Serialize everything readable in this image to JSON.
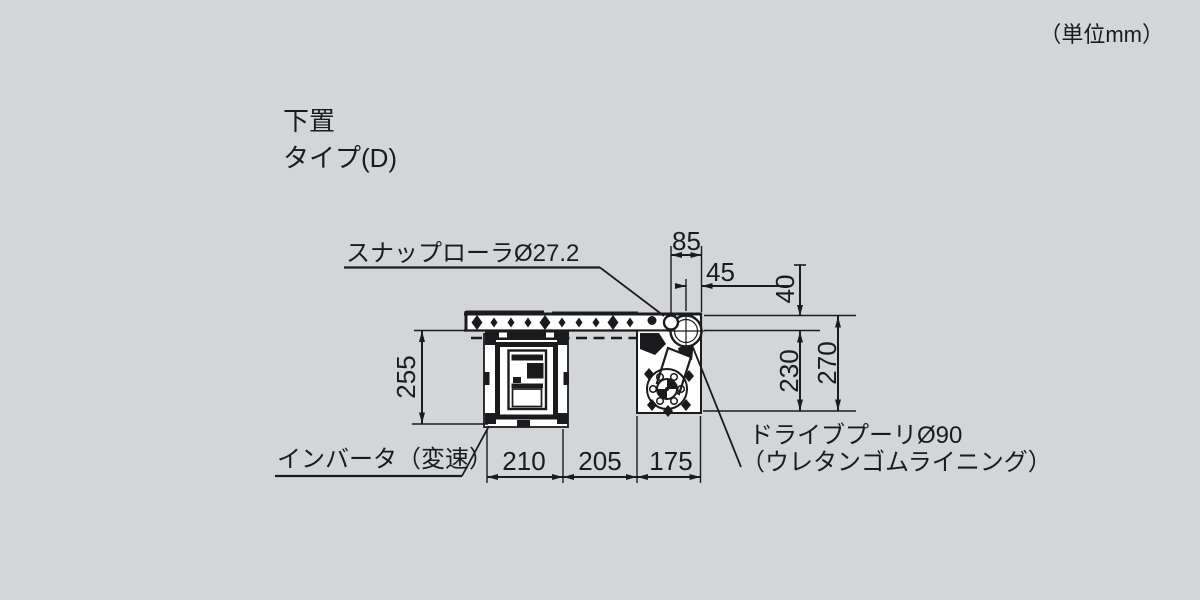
{
  "unit_note": "（単位mm）",
  "title": {
    "line1": "下置",
    "line2": "タイプ(D)"
  },
  "callouts": {
    "snap_roller": "スナップローラØ27.2",
    "inverter": "インバータ（変速）",
    "drive_pulley": "ドライブプーリØ90",
    "drive_pulley_note": "（ウレタンゴムライニング）"
  },
  "dimensions_mm": {
    "roller_to_end": "85",
    "pulley_to_end": "45",
    "top_to_pulley_center": "40",
    "pulley_center_to_base": "230",
    "top_to_base": "270",
    "inverter_drop": "255",
    "inverter_width": "210",
    "center_gap": "205",
    "drive_width": "175"
  },
  "colors": {
    "background": "#d3d6d8",
    "line": "#1b1b1d",
    "fill_white": "#ffffff"
  }
}
